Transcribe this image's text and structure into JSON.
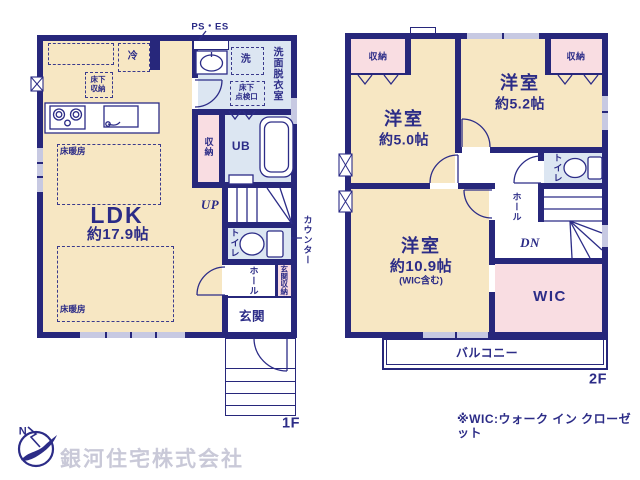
{
  "floor1": {
    "label": "1F",
    "ps_es": "PS・ES",
    "fridge": "冷",
    "washer": "洗",
    "washroom": "洗面脱衣室",
    "underfloor_hatch": "床下\n点検口",
    "underfloor_storage": "床下\n収納",
    "floor_heating_top": "床暖房",
    "floor_heating_bottom": "床暖房",
    "storage": "収納",
    "unit_bath": "UB",
    "ldk": {
      "name": "LDK",
      "area": "約17.9帖"
    },
    "up": "UP",
    "toilet": "トイレ",
    "counter": "カウンター",
    "hall": "ホール",
    "entrance_storage": "玄関収納",
    "entrance": "玄関"
  },
  "floor2": {
    "label": "2F",
    "closet_left": "収納",
    "closet_right": "収納",
    "bedroom_small_1": {
      "name": "洋室",
      "area": "約5.0帖"
    },
    "bedroom_small_2": {
      "name": "洋室",
      "area": "約5.2帖"
    },
    "bedroom_main": {
      "name": "洋室",
      "area": "約10.9帖",
      "note": "(WIC含む)"
    },
    "toilet": "トイレ",
    "hall": "ホール",
    "dn": "DN",
    "wic": "WIC",
    "balcony": "バルコニー"
  },
  "footer": {
    "wic_note": "※WIC:ウォーク イン クローゼット",
    "company": "銀河住宅株式会社",
    "compass_north": "N"
  },
  "colors": {
    "wall": "#27277b",
    "floor": "#f7e7c3",
    "wet_room": "#dce6f2",
    "closet": "#f9dde2",
    "window": "#c7c9e2"
  }
}
